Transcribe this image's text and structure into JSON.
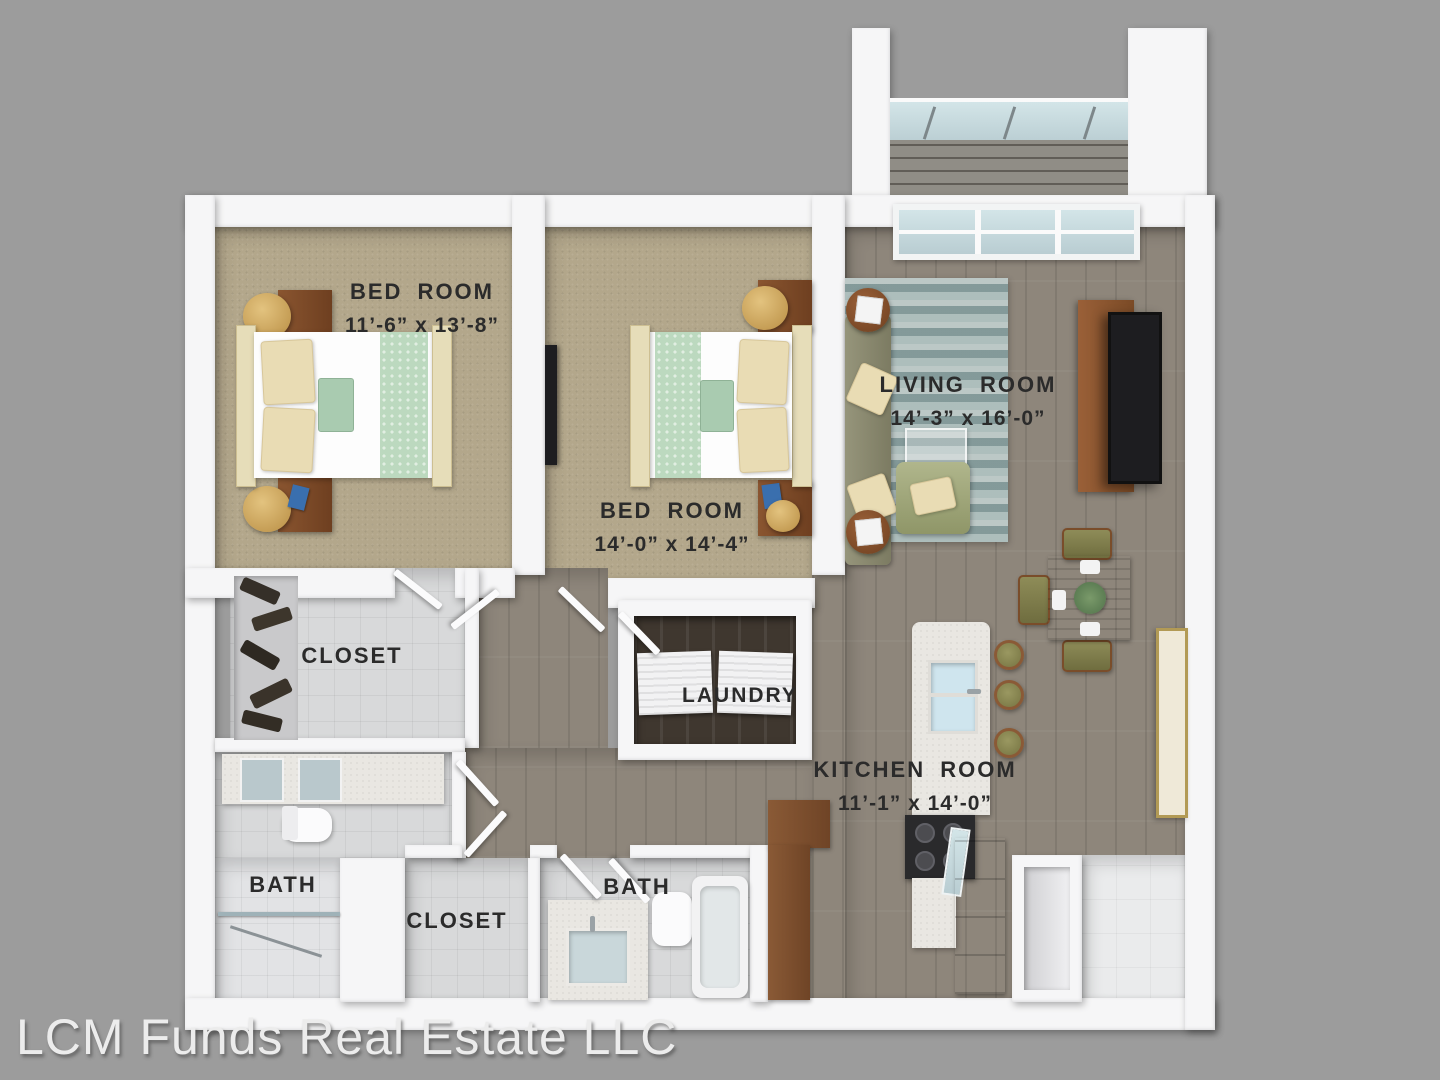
{
  "watermark": "LCM Funds Real Estate LLC",
  "rooms": [
    {
      "name": "BED ROOM",
      "dims": "11’-6” x 13’-8”"
    },
    {
      "name": "BED ROOM",
      "dims": "14’-0” x 14’-4”"
    },
    {
      "name": "LIVING ROOM",
      "dims": "14’-3” x 16’-0”"
    },
    {
      "name": "KITCHEN ROOM",
      "dims": "11’-1” x 14’-0”"
    },
    {
      "name": "LAUNDRY"
    },
    {
      "name": "CLOSET"
    },
    {
      "name": "BATH"
    },
    {
      "name": "CLOSET"
    },
    {
      "name": "BATH"
    }
  ],
  "colors": {
    "background": "#9c9c9c",
    "wall": "#f6f6f7",
    "carpet": "#b3a78b",
    "wood_floor": "#8e867b",
    "tile": "#d8d9da",
    "rug": "#9fb0ae",
    "cabinet_wood": "#8a5a36",
    "bedding_accent": "#bcd9bf",
    "upholstery": "#8d8d72",
    "label_text": "#2b2b2b"
  }
}
